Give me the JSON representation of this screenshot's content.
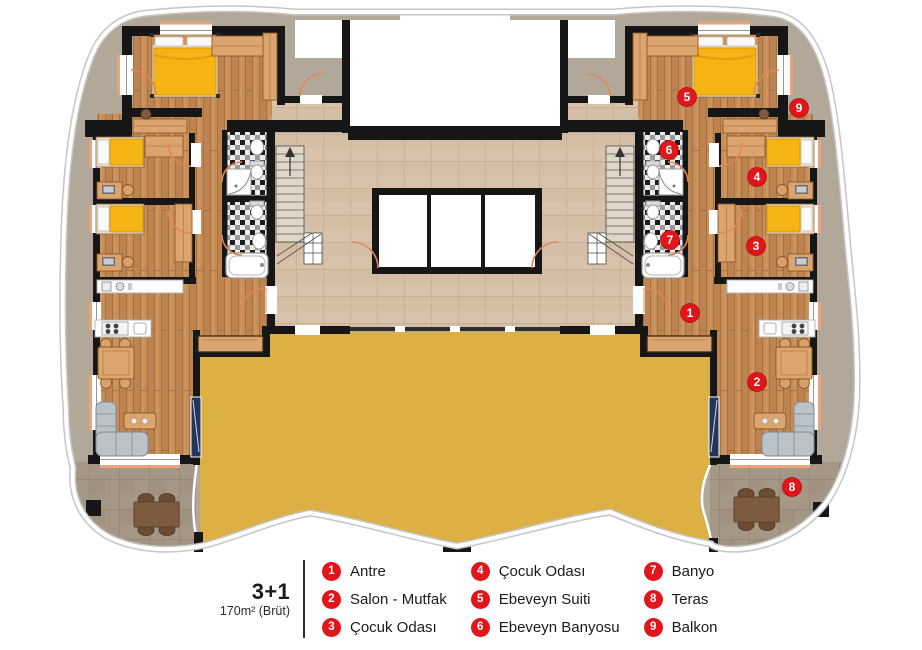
{
  "legend": {
    "unit_type": "3+1",
    "unit_area": "170m² (Brüt)",
    "columns": [
      [
        {
          "num": "1",
          "label": "Antre"
        },
        {
          "num": "2",
          "label": "Salon - Mutfak"
        },
        {
          "num": "3",
          "label": "Çocuk Odası"
        }
      ],
      [
        {
          "num": "4",
          "label": "Çocuk Odası"
        },
        {
          "num": "5",
          "label": "Ebeveyn Suiti"
        },
        {
          "num": "6",
          "label": "Ebeveyn Banyosu"
        }
      ],
      [
        {
          "num": "7",
          "label": "Banyo"
        },
        {
          "num": "8",
          "label": "Teras"
        },
        {
          "num": "9",
          "label": "Balkon"
        }
      ]
    ]
  },
  "plan": {
    "markers": [
      {
        "num": "1",
        "room": "Antre",
        "x": 690,
        "y": 313
      },
      {
        "num": "2",
        "room": "Salon - Mutfak",
        "x": 757,
        "y": 382
      },
      {
        "num": "3",
        "room": "Çocuk Odası",
        "x": 756,
        "y": 246
      },
      {
        "num": "4",
        "room": "Çocuk Odası",
        "x": 757,
        "y": 177
      },
      {
        "num": "5",
        "room": "Ebeveyn Suiti",
        "x": 687,
        "y": 97
      },
      {
        "num": "6",
        "room": "Ebeveyn Banyosu",
        "x": 669,
        "y": 150
      },
      {
        "num": "7",
        "room": "Banyo",
        "x": 670,
        "y": 240
      },
      {
        "num": "8",
        "room": "Teras",
        "x": 792,
        "y": 487
      },
      {
        "num": "9",
        "room": "Balkon",
        "x": 799,
        "y": 108
      }
    ],
    "colors": {
      "marker_red": "#e2151b",
      "terrace_yellow": "#ddb045",
      "wood_floor": "#c78e58",
      "hall_tile": "#d8c2ab",
      "outdoor_tile": "#a59786",
      "band_gray": "#b2a89a",
      "wall_black": "#161616"
    }
  }
}
